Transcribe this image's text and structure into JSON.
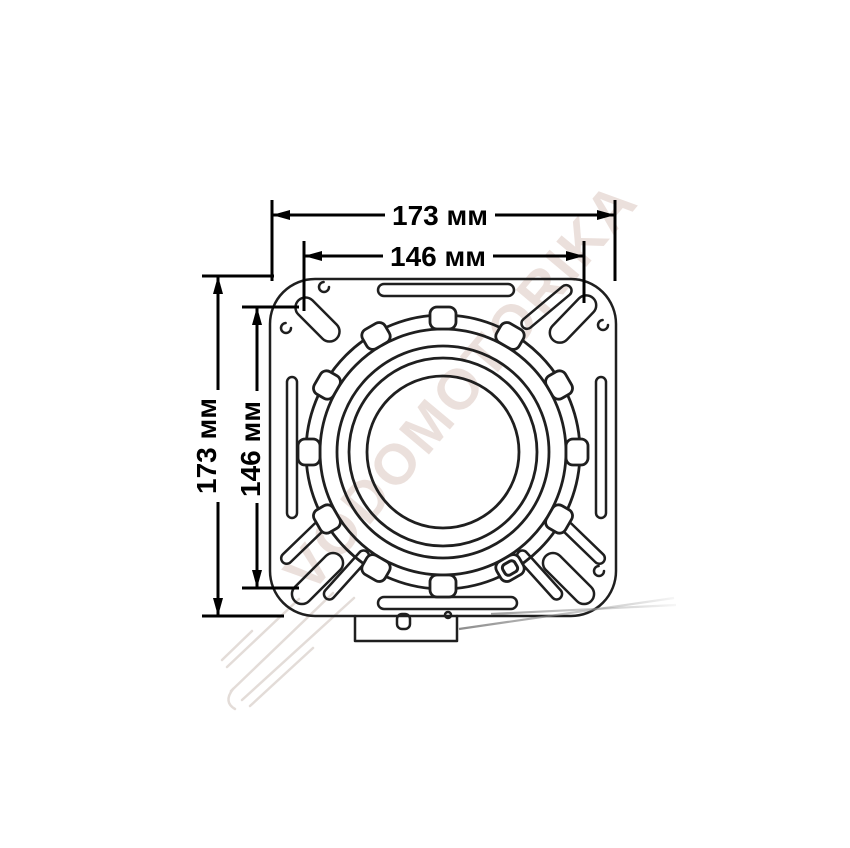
{
  "drawing": {
    "subject": "Swivel seat base mounting plate — dimensioned top view",
    "watermark": "VODOMOTORIKA",
    "colors": {
      "background": "#ffffff",
      "line": "#1f1f1f",
      "dimension": "#000000",
      "watermark": "#dcc8c0",
      "handle": "#7d7d7d"
    },
    "dimensions": {
      "top_outer": "173 мм",
      "top_inner": "146 мм",
      "left_outer": "173 мм",
      "left_inner": "146 мм"
    }
  }
}
